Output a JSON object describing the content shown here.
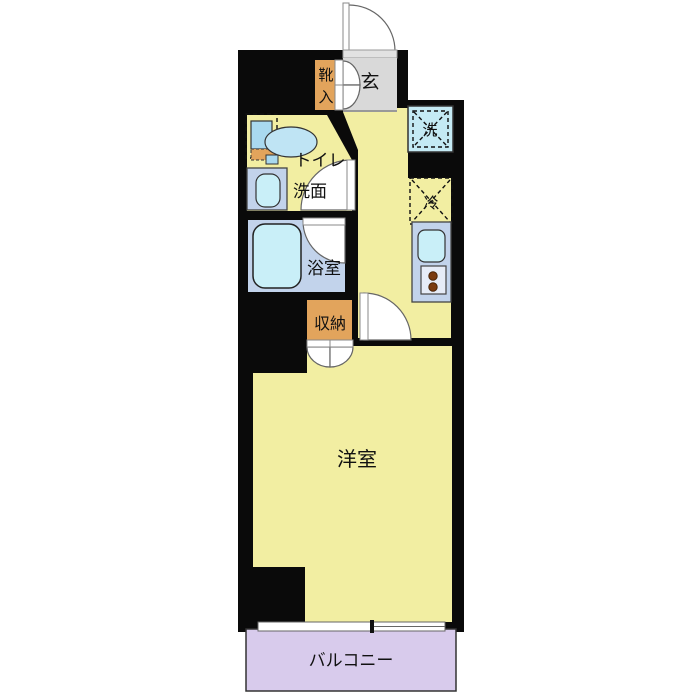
{
  "plan": {
    "rooms": {
      "entrance": {
        "label": "玄"
      },
      "shoe_cabinet": {
        "label": "靴入",
        "char1": "靴",
        "char2": "入"
      },
      "toilet": {
        "label": "トイレ"
      },
      "washroom": {
        "label": "洗面"
      },
      "bathroom": {
        "label": "浴室"
      },
      "storage": {
        "label": "収納"
      },
      "washer": {
        "label": "洗"
      },
      "refrigerator": {
        "label": "冷"
      },
      "western_room": {
        "label": "洋室"
      },
      "balcony": {
        "label": "バルコニー"
      }
    },
    "colors": {
      "wall": "#0a0a0a",
      "room_yellow": "#F2EEA2",
      "genkan_gray": "#D9D9D9",
      "threshold_gray": "#E2E2E2",
      "cabinet_orange": "#E2A45C",
      "wet_area_blue": "#C2D3EB",
      "fixture_cyan": "#C9EFF8",
      "washer_cyan": "#C4EAF4",
      "tank_blue": "#A9D9EF",
      "bowl_blue": "#BFE4F4",
      "stove_panel": "#E6ECF7",
      "burner_brown": "#7A3B10",
      "balcony_lavender": "#D8CBEC"
    }
  }
}
